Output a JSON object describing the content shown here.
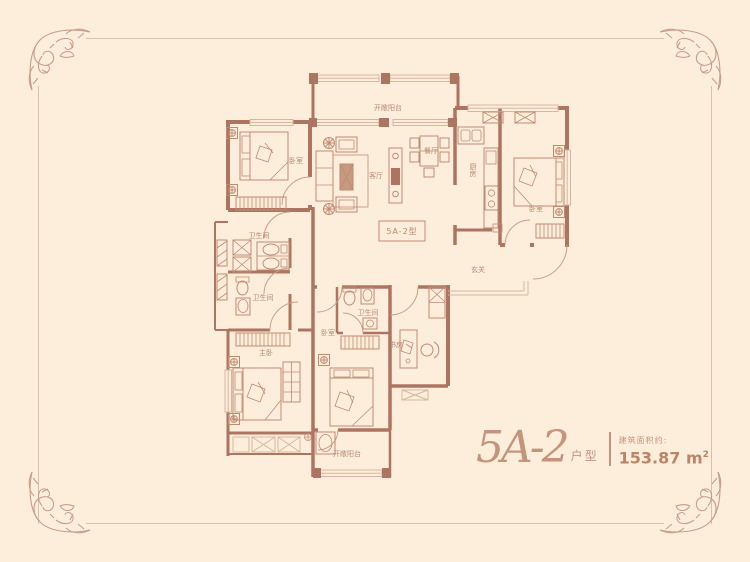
{
  "background_color": "#fdeedc",
  "frame": {
    "line_color": "#d9bfae",
    "ornament_color": "#c79e89"
  },
  "plan": {
    "wall_color": "#ad7561",
    "window_color": "#d8b59e",
    "furniture_color": "#c08a72",
    "label_color": "#b9886f",
    "unit_code_box": "5A-2型",
    "rooms": [
      {
        "id": "balcony-top",
        "label": "开敞阳台"
      },
      {
        "id": "living-room",
        "label": "客厅"
      },
      {
        "id": "dining-room",
        "label": "餐厅"
      },
      {
        "id": "bedroom-nw",
        "label": "卧室"
      },
      {
        "id": "kitchen",
        "label": "厨房"
      },
      {
        "id": "bedroom-ne",
        "label": "卧室"
      },
      {
        "id": "bathroom-1",
        "label": "卫生间"
      },
      {
        "id": "bathroom-2",
        "label": "卫生间"
      },
      {
        "id": "entry",
        "label": "玄关"
      },
      {
        "id": "master-bedroom",
        "label": "主卧"
      },
      {
        "id": "bedroom-s",
        "label": "卧室"
      },
      {
        "id": "bathroom-3",
        "label": "卫生间"
      },
      {
        "id": "study",
        "label": "书房"
      },
      {
        "id": "balcony-bottom",
        "label": "开敞阳台"
      }
    ]
  },
  "title": {
    "script": "5A-2",
    "suffix": "户型",
    "area_label": "建筑面积约:",
    "area_value": "153.87",
    "area_unit": "m",
    "area_exp": "2",
    "color": "#c4947c"
  }
}
